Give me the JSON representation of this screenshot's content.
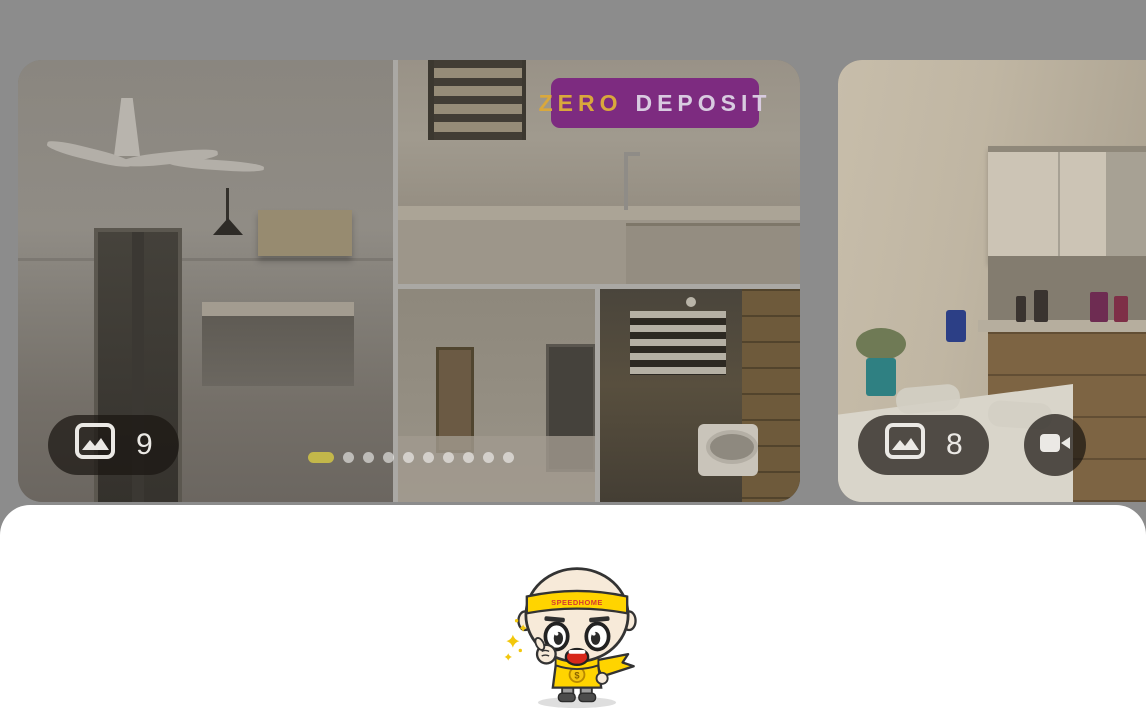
{
  "brand": {
    "accent_purple": "#7d2b80",
    "accent_yellow": "#ffd400",
    "backdrop_gray": "#8c8c8c"
  },
  "gallery": {
    "zero_deposit_badge": {
      "zero": "ZERO",
      "deposit": "DEPOSIT"
    },
    "listing_card": {
      "photo_count": "9",
      "photo_count_icon": "image-icon",
      "dots": {
        "count": 10,
        "active_index": 0,
        "active_color": "#c3b74a"
      }
    },
    "next_listing_card": {
      "photo_count": "8",
      "photo_count_icon": "image-icon",
      "video_icon": "video-camera-icon"
    }
  },
  "bottom_sheet": {
    "mascot": {
      "name": "speedhome-mascot",
      "headband_text": "SPEEDHOME"
    }
  }
}
